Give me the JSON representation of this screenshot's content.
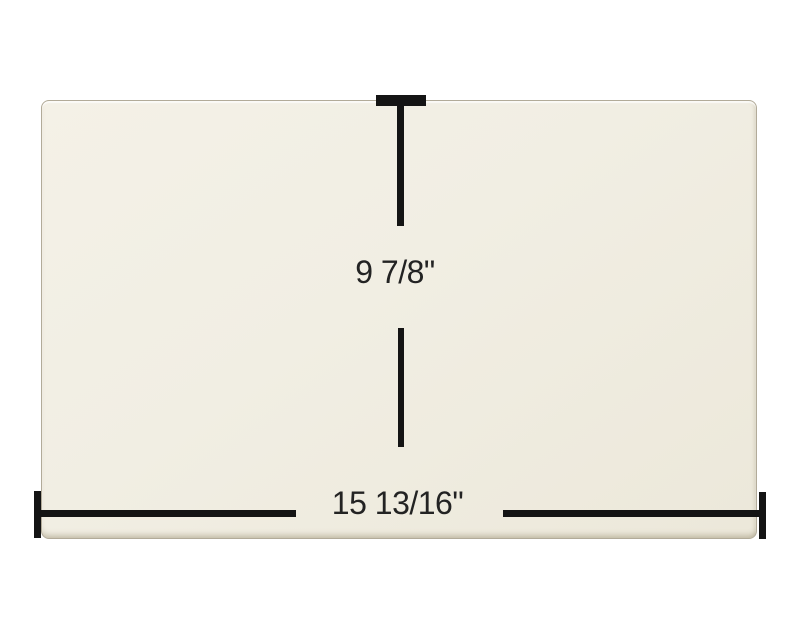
{
  "diagram": {
    "kind": "product-dimension-diagram",
    "dimensions": {
      "height_label": "9 7/8\"",
      "width_label": "15 13/16\""
    },
    "colors": {
      "background": "#ffffff",
      "panel_fill": "#f1eee3",
      "panel_edge": "#b2ab99",
      "dimension_line": "#141414",
      "label_text": "#232323"
    }
  }
}
